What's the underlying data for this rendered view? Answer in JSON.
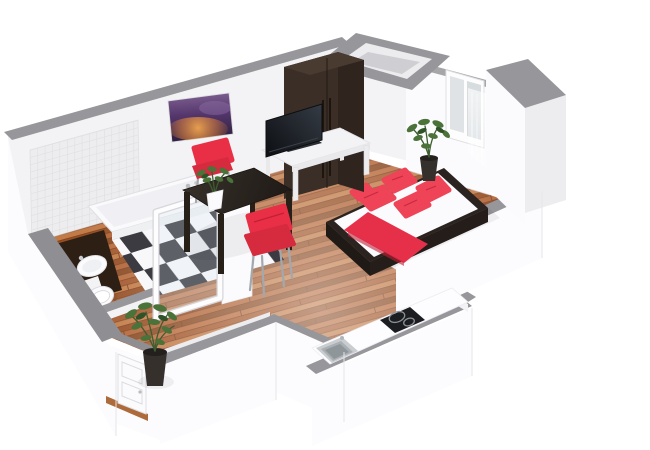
{
  "scene": {
    "description": "Isometric 3D rendering of a studio apartment floor plan with open-top walls",
    "rooms": [
      {
        "name": "living-dining-area",
        "floor": "wood parquet"
      },
      {
        "name": "sleeping-area",
        "floor": "wood parquet"
      },
      {
        "name": "bathroom",
        "floor": "black-white checkerboard tile"
      },
      {
        "name": "entry-hall",
        "floor": "wood parquet"
      },
      {
        "name": "kitchenette-nook",
        "floor": "white counter"
      }
    ],
    "furniture": [
      {
        "name": "double-bed",
        "detail": "white mattress, red runner, red pillows, dark frame"
      },
      {
        "name": "wardrobe",
        "detail": "tall dark brown cabinet"
      },
      {
        "name": "tv",
        "detail": "black flat screen on white bench"
      },
      {
        "name": "tv-bench",
        "detail": "low white table"
      },
      {
        "name": "dining-table",
        "detail": "dark square table"
      },
      {
        "name": "chair-red-north",
        "detail": "red shell chair"
      },
      {
        "name": "chair-red-south",
        "detail": "red shell chair"
      },
      {
        "name": "plant-bedroom",
        "detail": "potted plant by window"
      },
      {
        "name": "plant-hall",
        "detail": "potted plant by entry"
      },
      {
        "name": "plant-table",
        "detail": "small plant in white pot"
      },
      {
        "name": "bathtub",
        "detail": "white tub along tiled wall"
      },
      {
        "name": "vanity-washbasin",
        "detail": "dark counter with round white basin"
      },
      {
        "name": "toilet",
        "detail": "white wc"
      },
      {
        "name": "shower-glass-door",
        "detail": "white framed glass door"
      },
      {
        "name": "entry-door",
        "detail": "white paneled door"
      },
      {
        "name": "window",
        "detail": "two-pane window with sheer curtain"
      },
      {
        "name": "kitchen-counter",
        "detail": "white counter with steel sink and black cooktop"
      },
      {
        "name": "wall-artwork",
        "detail": "purple and orange sky picture"
      },
      {
        "name": "ventilation-shaft",
        "detail": "open-top duct enclosure"
      }
    ],
    "colors": {
      "wall_face": "#f3f3f5",
      "wall_face_bright": "#fbfbfd",
      "wall_face_shaded": "#ededf0",
      "wall_outer": "#fcfcfe",
      "wall_top": "#97979b",
      "wood_1": "#b96b3c",
      "wood_2": "#a4572b",
      "wood_3": "#c27a46",
      "wood_4": "#964e23",
      "wood_5": "#b26436",
      "wood_6": "#8a4a22",
      "wood_seam": "#7a3e1d",
      "checker_dark": "#3b3b41",
      "checker_light": "#f8f8fa",
      "tile_fill": "#ededef",
      "tile_line": "#dddde0",
      "pillow_red": "#ef4357",
      "runner_red": "#e63049",
      "chair_red": "#e92f46",
      "chair_red_deep": "#d62a3f",
      "wardrobe_front": "#3a2e27",
      "wardrobe_side": "#2f241e",
      "wardrobe_top": "#4a3b31",
      "table_dark": "#2b2522",
      "leg_dark": "#262019",
      "bench_white": "#f3f3f5",
      "tv_dark": "#15171b",
      "counter_white": "#fdfdff",
      "cooktop_black": "#1b1d20",
      "sink_steel": "#c9cdd0",
      "sink_basin": "#a9afb3",
      "plant_green": "#4a7239",
      "plant_green_dark": "#2f5227",
      "pot_dark": "#35302c",
      "pot_white": "#fbfbfd",
      "tub_white": "#fafafc",
      "fixture_white": "#fbfbfd",
      "vanity_brown": "#2e1f15",
      "door_white": "#fbfbfd",
      "threshold_wood": "#ad6a3a"
    }
  }
}
